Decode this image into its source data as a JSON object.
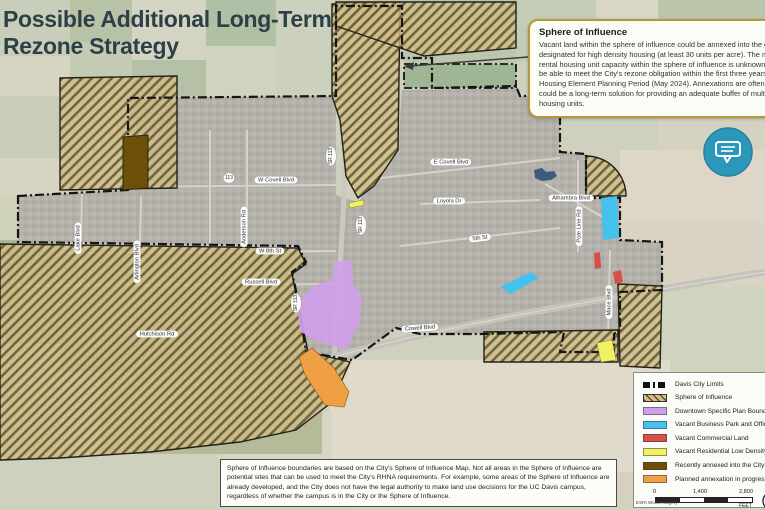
{
  "title": {
    "line1": "Possible Additional Long-Term",
    "line2": "Rezone Strategy"
  },
  "callout": {
    "heading": "Sphere of Influence",
    "body": "Vacant land within the sphere of influence could be annexed into the city and designated for high density housing (at least 30 units per acre). The multi-family rental housing unit capacity within the sphere of influence is unknown and may not be able to meet the City's rezone obligation within the first three years of the Housing Element Planning Period (May 2024). Annexations are often complex but could be a long-term solution for providing an adequate buffer of multi-family rental housing units."
  },
  "note": {
    "text": "Sphere of Influence boundaries are based on the City's Sphere of Influence Map. Not all areas in the Sphere of Influence are potential sites that can be used to meet the City's RHNA requirements. For example, some areas of the Sphere of Influence are already developed, and the City does not have the legal authority to make land use decisions for the UC Davis campus, regardless of whether the campus is in the City or the Sphere of Influence."
  },
  "legend": {
    "items": [
      {
        "label": "Davis City Limits",
        "type": "city-limits-line"
      },
      {
        "label": "Sphere of Influence",
        "type": "hatch"
      },
      {
        "label": "Downtown Specific Plan Boundary",
        "color": "#cf9fe8"
      },
      {
        "label": "Vacant Business Park and Office Land",
        "color": "#45c1ee"
      },
      {
        "label": "Vacant Commercial Land",
        "color": "#d6504a"
      },
      {
        "label": "Vacant Residential Low Density Land",
        "color": "#f2f163"
      },
      {
        "label": "Recently annexed into the City of Davis",
        "color": "#6e4f07"
      },
      {
        "label": "Planned annexation in progress",
        "color": "#efa045"
      }
    ],
    "scale": {
      "tick0": "0",
      "tick1": "1,400",
      "tick2": "2,800",
      "unit": "FEET"
    },
    "credit_left": "ESRI World Imagery",
    "credit_right": "10/30/2023",
    "north_label": "N"
  },
  "map": {
    "road_labels": [
      {
        "text": "W Covell Blvd"
      },
      {
        "text": "E Covell Blvd"
      },
      {
        "text": "Loyola Dr"
      },
      {
        "text": "Alhambra Blvd"
      },
      {
        "text": "5th St"
      },
      {
        "text": "W 8th St"
      },
      {
        "text": "Russell Blvd"
      },
      {
        "text": "Cowell Blvd"
      },
      {
        "text": "Hutchison Rd"
      },
      {
        "text": "Lake Blvd"
      },
      {
        "text": "Arlington Blvd"
      },
      {
        "text": "Anderson Rd"
      },
      {
        "text": "Mace Blvd"
      },
      {
        "text": "Pole Line Rd"
      },
      {
        "text": "SR 113"
      },
      {
        "text": "SR 113"
      },
      {
        "text": "SR 113"
      },
      {
        "text": "113"
      }
    ],
    "colors": {
      "callout_border_gold": "#b5983c",
      "chat_button_teal": "#2b97bb",
      "title_text": "#2e3f48",
      "sphere_hatch_fill": "#d2bd85",
      "downtown_purple": "#cf9fe8",
      "business_park_cyan": "#45c1ee",
      "commercial_red": "#d6504a",
      "residential_yellow": "#f2f163",
      "annexed_brown": "#6e4f07",
      "annexation_orange": "#efa045",
      "city_limits_black": "#151515"
    }
  }
}
